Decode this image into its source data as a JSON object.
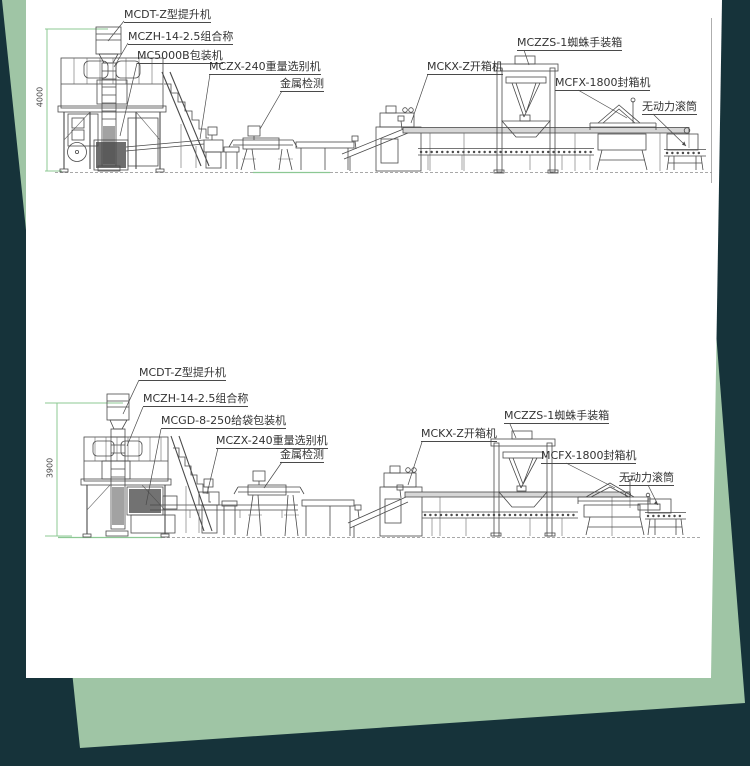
{
  "colors": {
    "backdrop_teal": "#16333a",
    "sheet_green": "#9fc5a5",
    "paper_white": "#ffffff",
    "dimension_green": "#8cc893",
    "drawing_line_gray": "#4a4a4a",
    "label_text": "#333333"
  },
  "diagrams": [
    {
      "name": "packaging-line-top",
      "dimension_label": "4000",
      "labels": {
        "elevator": "MCDT-Z型提升机",
        "combination_weigher": "MCZH-14-2.5组合称",
        "packaging_machine": "MC5000B包装机",
        "checkweigher": "MCZX-240重量选别机",
        "metal_detector": "金属检测",
        "case_opener": "MCKX-Z开箱机",
        "spider_case_packer": "MCZZS-1蜘蛛手装箱",
        "case_sealer": "MCFX-1800封箱机",
        "gravity_roller": "无动力滚筒"
      }
    },
    {
      "name": "packaging-line-bottom",
      "dimension_label": "3900",
      "labels": {
        "elevator": "MCDT-Z型提升机",
        "combination_weigher": "MCZH-14-2.5组合称",
        "packaging_machine": "MCGD-8-250给袋包装机",
        "checkweigher": "MCZX-240重量选别机",
        "metal_detector": "金属检测",
        "case_opener": "MCKX-Z开箱机",
        "spider_case_packer": "MCZZS-1蜘蛛手装箱",
        "case_sealer": "MCFX-1800封箱机",
        "gravity_roller": "无动力滚筒"
      }
    }
  ]
}
